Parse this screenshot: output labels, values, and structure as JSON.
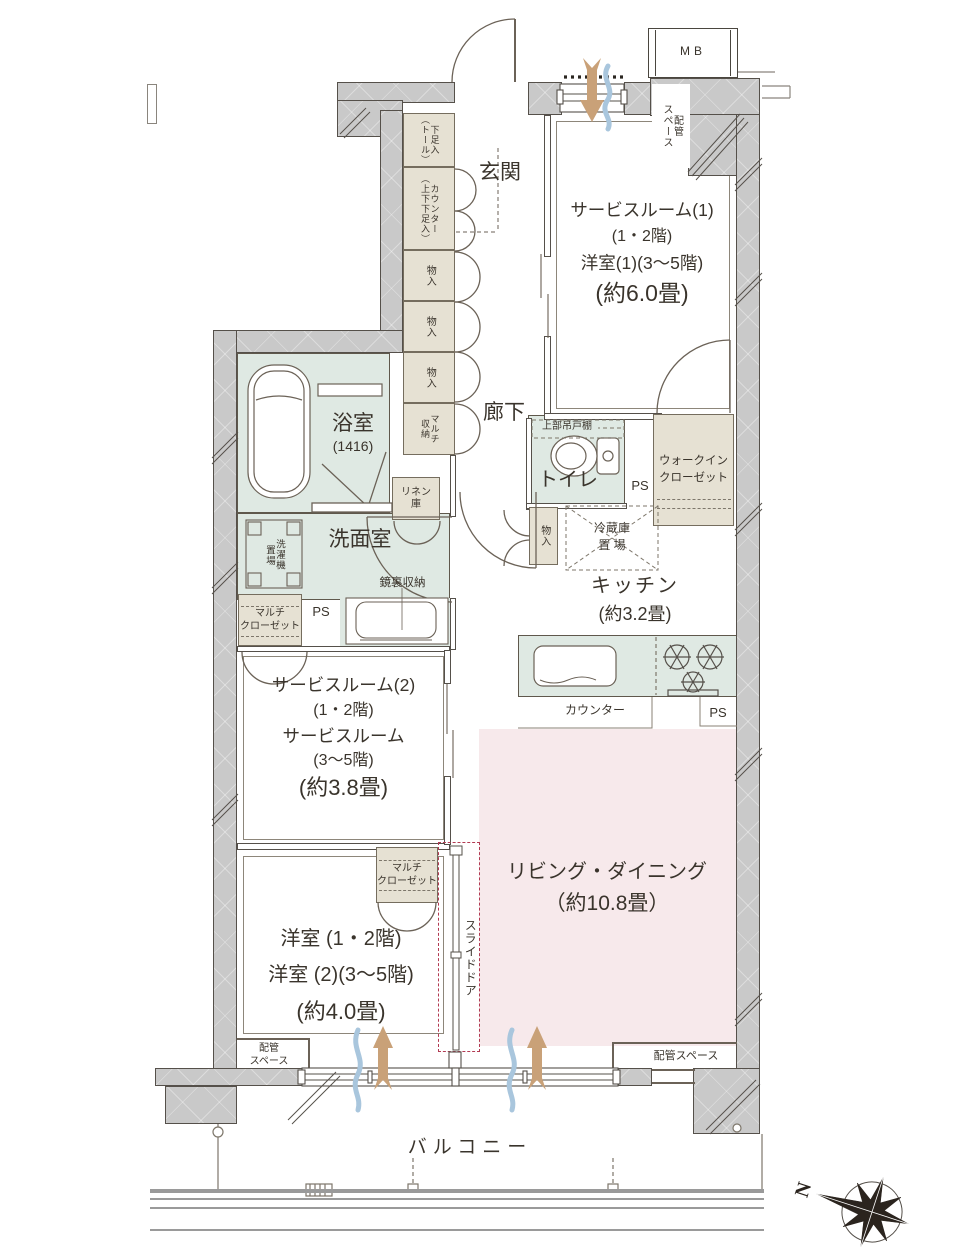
{
  "labels": {
    "mb": "MB",
    "ps": "PS",
    "north": "N",
    "balcony": "バルコニー",
    "pipe_space": "配管スペース",
    "pipe_space_a": "配管",
    "pipe_space_b": "スペース",
    "counter": "カウンター",
    "slide_door": "スライドドア",
    "upper_cabinet": "上部吊戸棚",
    "mirror_storage": "鏡裏収納",
    "fridge_a": "冷蔵庫",
    "fridge_b": "置 場"
  },
  "rooms": {
    "genkan": "玄関",
    "corridor": "廊下",
    "service1": {
      "l1": "サービスルーム(1)",
      "l2": "(1・2階)",
      "l3": "洋室(1)(3〜5階)",
      "l4": "(約6.0畳)"
    },
    "bath": {
      "name": "浴室",
      "size": "(1416)"
    },
    "washroom": {
      "name": "洗面室"
    },
    "toilet": {
      "name": "トイレ"
    },
    "wic": {
      "l1": "ウォークイン",
      "l2": "クローゼット"
    },
    "kitchen": {
      "name": "キッチン",
      "size": "(約3.2畳)"
    },
    "service2": {
      "l1": "サービスルーム(2)",
      "l2": "(1・2階)",
      "l3": "サービスルーム",
      "l4": "(3〜5階)",
      "l5": "(約3.8畳)"
    },
    "living": {
      "l1": "リビング・ダイニング",
      "l2": "（約10.8畳）"
    },
    "bedroom": {
      "l1": "洋室 (1・2階)",
      "l2": "洋室 (2)(3〜5階)",
      "l3": "(約4.0畳)"
    }
  },
  "storage": {
    "shoe_tall_a": "下足入",
    "shoe_tall_b": "（トール）",
    "shoe_counter_a": "カウンター",
    "shoe_counter_b": "（上下下足入）",
    "mono": "物入",
    "multi_a": "マルチ",
    "multi_b": "収納",
    "multi_closet_a": "マルチ",
    "multi_closet_b": "クローゼット",
    "washer_a": "洗濯機",
    "washer_b": "置場",
    "linen_a": "リネン",
    "linen_b": "庫"
  },
  "colors": {
    "wall": "#c9c9c9",
    "wet_room": "#dfe9e3",
    "living": "#f7e9eb",
    "storage": "#e6e1d3",
    "slide_accent": "#b23a52",
    "arrow_tan": "#c9a178",
    "arrow_blue": "#a9c6dd"
  }
}
